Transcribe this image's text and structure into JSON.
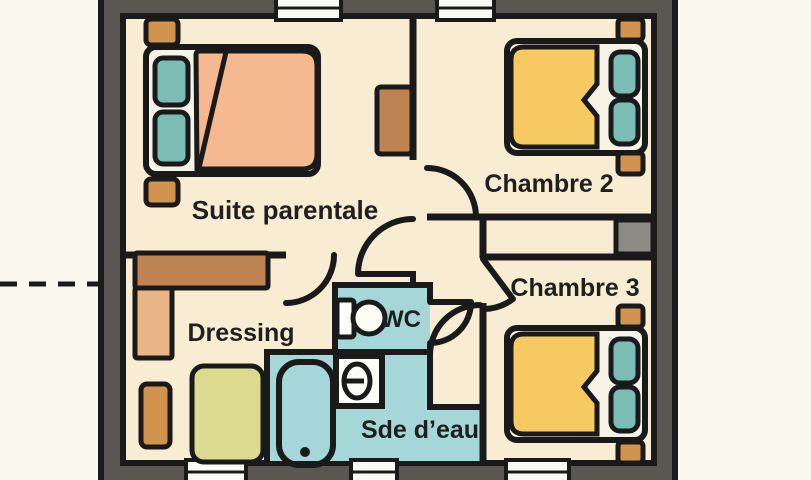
{
  "plan": {
    "type": "floor-plan",
    "floor_label": ""
  },
  "rooms": {
    "suite_parentale": {
      "label": "Suite parentale"
    },
    "chambre_2": {
      "label": "Chambre 2"
    },
    "chambre_3": {
      "label": "Chambre 3"
    },
    "dressing": {
      "label": "Dressing"
    },
    "wc": {
      "label": "WC"
    },
    "sde_eau": {
      "label": "Sde d’eau"
    }
  },
  "colors": {
    "outside_background": "#faf7ee",
    "floor": "#f8ecd2",
    "exterior_wall": "#5a5752",
    "line": "#1a1a1a",
    "wet_room_floor": "#a6d7d8",
    "bed_frame": "#f7f3e6",
    "duvet_master": "#f6b98f",
    "duvet_guest": "#f6c963",
    "pillow": "#7bbcb4",
    "nightstand": "#d2934f",
    "wardrobe_dark": "#bf8351",
    "wardrobe_light": "#eab584",
    "rug": "#dbda8e",
    "closet_block": "#8d8b86",
    "window": "#fdfdf8",
    "sanitary_white": "#fdfdf8"
  }
}
